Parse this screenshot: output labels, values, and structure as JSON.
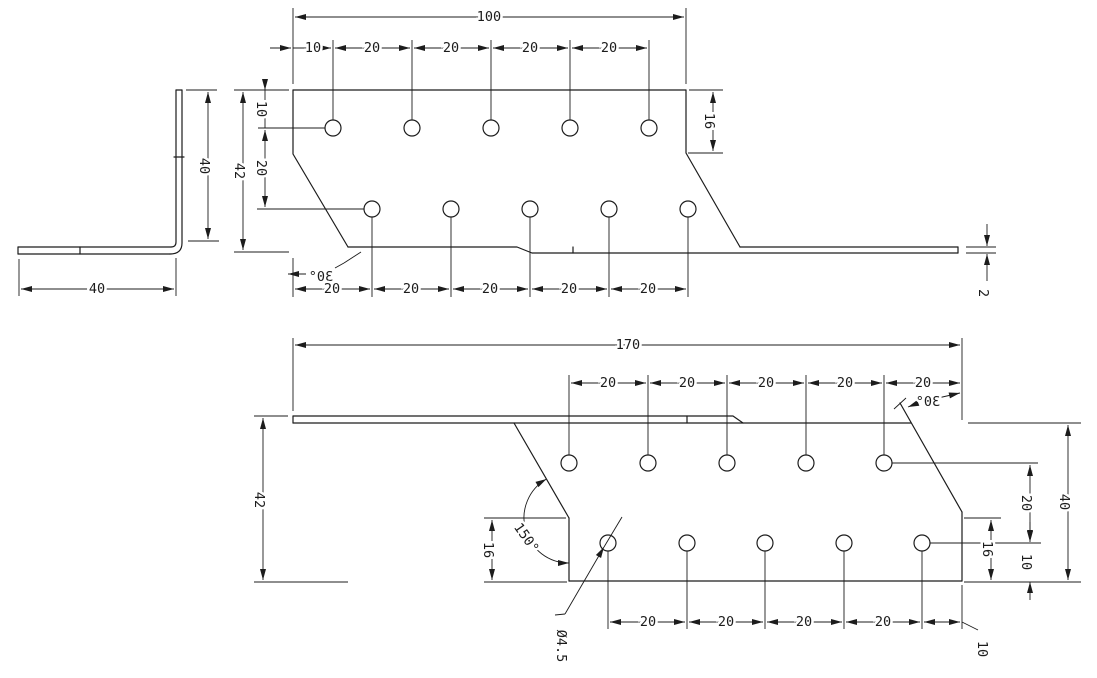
{
  "drawing": {
    "type": "technical-drawing",
    "part": "L-shaped perforated angle bracket",
    "side_view": {
      "leg": "40",
      "height": "40"
    },
    "top_view": {
      "width": "100",
      "top_pitch": [
        "10",
        "20",
        "20",
        "20",
        "20"
      ],
      "height": "42",
      "edge_to_row1": "10",
      "row_gap": "20",
      "right_edge_to_bend": "16",
      "corner_angle": "30°",
      "bottom_pitch": [
        "20",
        "20",
        "20",
        "20",
        "20"
      ],
      "thickness": "2"
    },
    "bottom_view": {
      "length": "170",
      "top_pitch": [
        "20",
        "20",
        "20",
        "20",
        "20"
      ],
      "corner_angle": "30°",
      "height": "42",
      "bend_angle": "150°",
      "left_edge_to_bottom": "16",
      "row_gap": "20",
      "flange_height": "40",
      "right_edge_to_bottom": "16",
      "row2_to_bottom": "10",
      "hole_diameter": "Ø4.5",
      "bottom_pitch": [
        "20",
        "20",
        "20",
        "20"
      ],
      "last_pitch": "10"
    }
  }
}
